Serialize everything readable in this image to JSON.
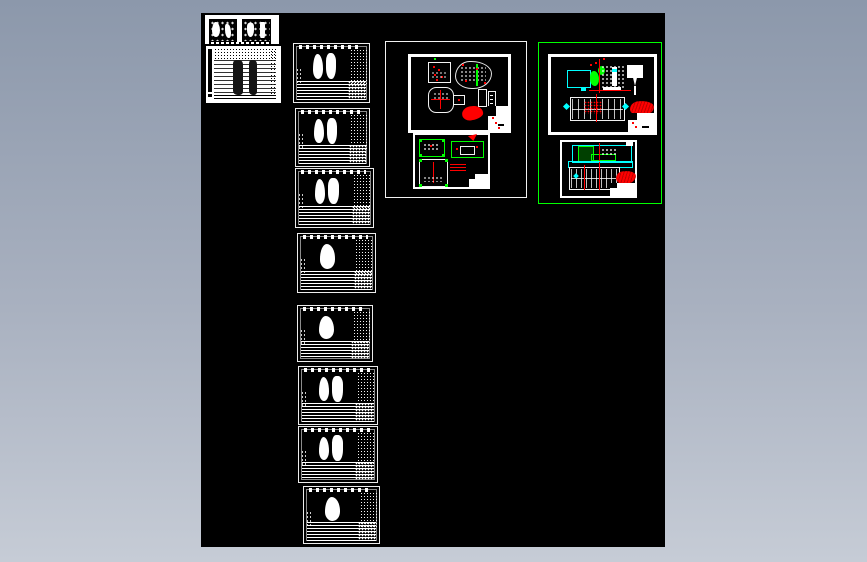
{
  "workspace": {
    "application": "cad-model-space",
    "canvas_background": "#000000",
    "desktop_gradient_top": "#8c98ab",
    "desktop_gradient_bottom": "#c6ccd6",
    "selection_highlight": "#00ff00",
    "palette": {
      "lines": "#ffffff",
      "annotation_red": "#ff0000",
      "fixture_green": "#00ff00",
      "fitting_cyan": "#00ffff"
    }
  },
  "thumbnails": {
    "parts_table": {
      "id": "parts-table-thumbnail"
    },
    "sheets": [
      {
        "id": "sheet-1",
        "blobs": 2
      },
      {
        "id": "sheet-2",
        "blobs": 2
      },
      {
        "id": "sheet-3",
        "blobs": 2
      },
      {
        "id": "sheet-4",
        "blobs": 1
      },
      {
        "id": "sheet-5",
        "blobs": 1
      },
      {
        "id": "sheet-6",
        "blobs": 2
      },
      {
        "id": "sheet-7",
        "blobs": 2
      },
      {
        "id": "sheet-8",
        "blobs": 1
      }
    ]
  },
  "layout_groups": [
    {
      "id": "group-1",
      "selected": false,
      "drawing_count": 2
    },
    {
      "id": "group-2",
      "selected": true,
      "drawing_count": 2
    }
  ]
}
